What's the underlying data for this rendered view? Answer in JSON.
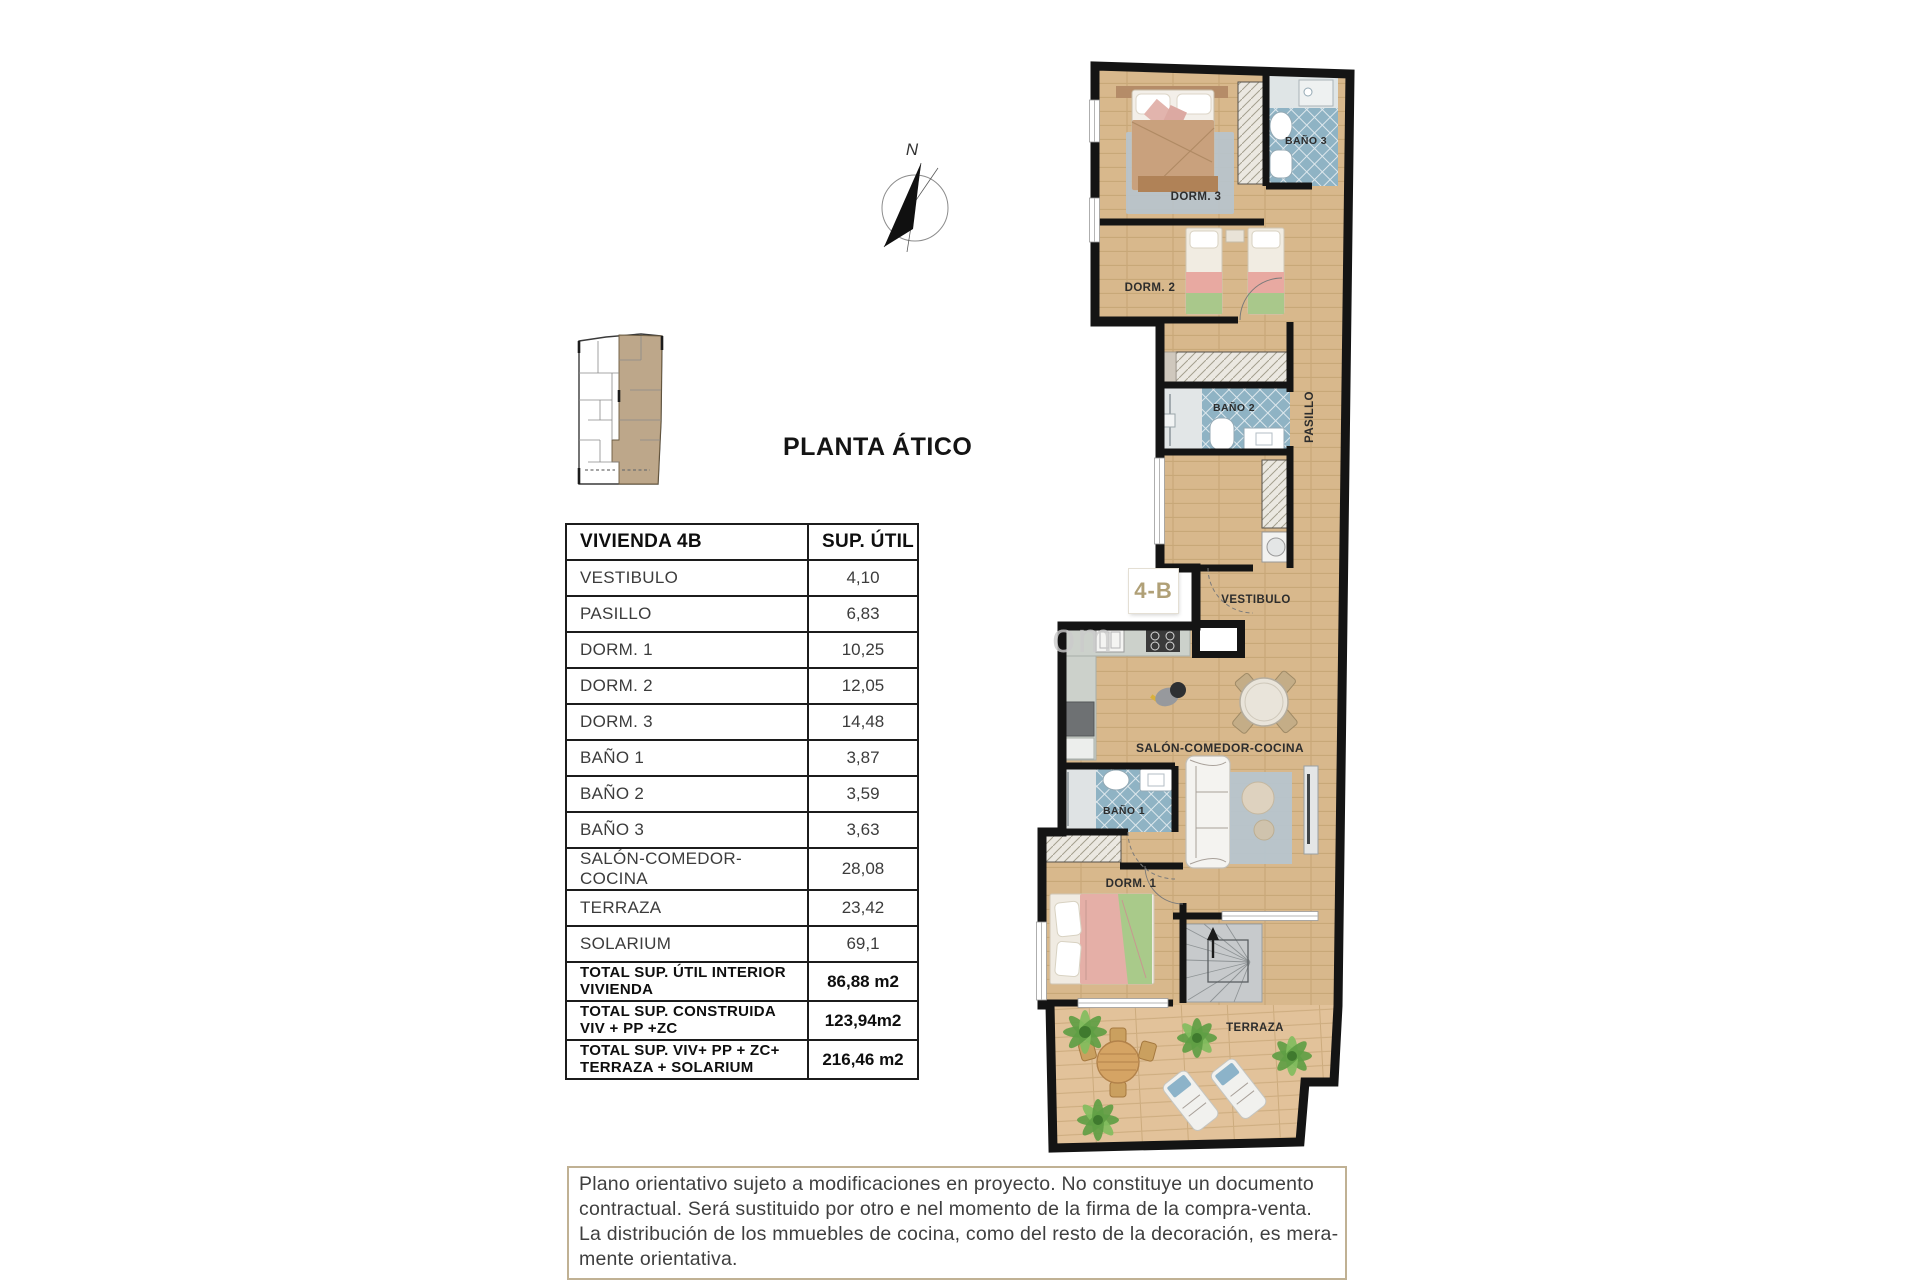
{
  "page": {
    "title_label": "PLANTA ÁTICO"
  },
  "compass": {
    "north_label": "N"
  },
  "watermark": {
    "visible_text": "om"
  },
  "plan": {
    "unit_badge": "4-B",
    "rooms": {
      "dorm3": "DORM. 3",
      "bano3": "BAÑO 3",
      "dorm2": "DORM. 2",
      "pasillo": "PASILLO",
      "bano2": "BAÑO 2",
      "vestibulo": "VESTIBULO",
      "salon": "SALÓN-COMEDOR-COCINA",
      "bano1": "BAÑO 1",
      "dorm1": "DORM. 1",
      "terraza": "TERRAZA"
    }
  },
  "table": {
    "header": {
      "name": "VIVIENDA 4B",
      "area": "SUP. ÚTIL"
    },
    "rows": [
      {
        "name": "VESTIBULO",
        "area": "4,10"
      },
      {
        "name": "PASILLO",
        "area": "6,83"
      },
      {
        "name": "DORM. 1",
        "area": "10,25"
      },
      {
        "name": "DORM. 2",
        "area": "12,05"
      },
      {
        "name": "DORM. 3",
        "area": "14,48"
      },
      {
        "name": "BAÑO 1",
        "area": "3,87"
      },
      {
        "name": "BAÑO 2",
        "area": "3,59"
      },
      {
        "name": "BAÑO 3",
        "area": "3,63"
      },
      {
        "name": "SALÓN-COMEDOR-COCINA",
        "area": "28,08"
      },
      {
        "name": "TERRAZA",
        "area": "23,42"
      },
      {
        "name": "SOLARIUM",
        "area": "69,1"
      }
    ],
    "totals": [
      {
        "line1": "TOTAL SUP. ÚTIL INTERIOR",
        "line2": "VIVIENDA",
        "area": "86,88 m2"
      },
      {
        "line1": "TOTAL SUP. CONSTRUIDA",
        "line2": "VIV + PP +ZC",
        "area": "123,94m2"
      },
      {
        "line1": "TOTAL SUP. VIV+ PP + ZC+",
        "line2": "TERRAZA + SOLARIUM",
        "area": "216,46 m2"
      }
    ]
  },
  "disclaimer": {
    "lines": [
      "Plano orientativo sujeto a modificaciones en proyecto. No constituye un documento",
      "contractual. Será sustituido por otro e nel momento de la firma de la compra-venta.",
      "La distribución de los mmuebles de cocina, como del resto de la decoración, es mera-",
      "mente orientativa."
    ]
  },
  "colors": {
    "wood": "#d8b88c",
    "wood_light": "#e2c29a",
    "wall": "#141414",
    "tile": "#8fb3c4",
    "rug": "#b7c4ce",
    "accent_tan": "#b0a077",
    "plant_green": "#5f9e44",
    "disclaimer_border": "#c0b194"
  }
}
